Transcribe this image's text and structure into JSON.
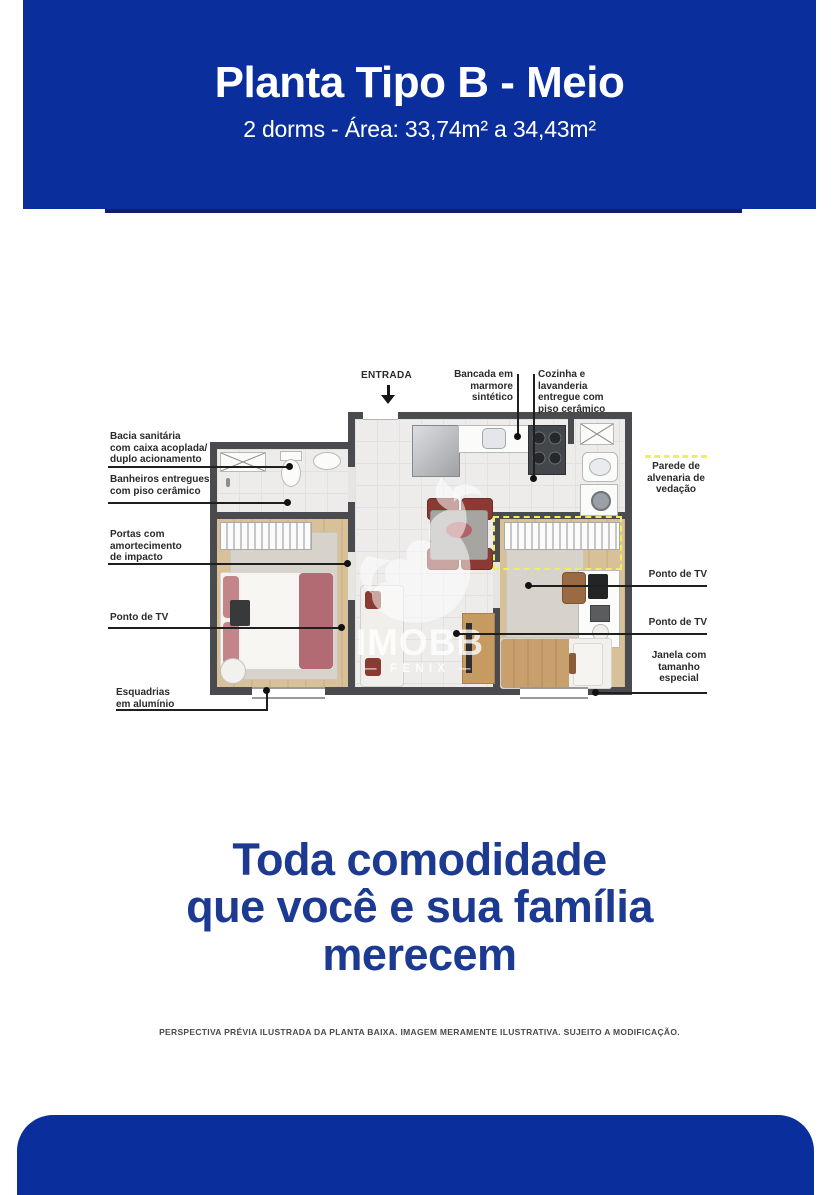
{
  "header": {
    "title": "Planta Tipo B - Meio",
    "subtitle": "2 dorms - Área: 33,74m² a 34,43m²"
  },
  "plan": {
    "entrance_label": "ENTRADA",
    "top_callouts": [
      {
        "label": "Bancada em\nmarmore\nsintético"
      },
      {
        "label": "Cozinha e\nlavanderia\nentregue com\npiso cerâmico"
      }
    ],
    "left_callouts": [
      {
        "label": "Bacia sanitária\ncom caixa acoplada/\nduplo acionamento"
      },
      {
        "label": "Banheiros entregues\ncom piso cerâmico"
      },
      {
        "label": "Portas com\namortecimento\nde impacto"
      },
      {
        "label": "Ponto de TV"
      },
      {
        "label": "Esquadrias\nem alumínio"
      }
    ],
    "right_callouts": [
      {
        "label": "Parede de\nalvenaria de\nvedação"
      },
      {
        "label": "Ponto de TV"
      },
      {
        "label": "Ponto de TV"
      },
      {
        "label": "Janela com\ntamanho\nespecial"
      }
    ],
    "watermark": {
      "brand": "IMOBB",
      "tagline": "— FENIX —"
    }
  },
  "headline": {
    "lines": [
      "Toda comodidade",
      "que você e sua família",
      "merecem"
    ]
  },
  "disclaimer": "PERSPECTIVA PRÉVIA ILUSTRADA DA PLANTA BAIXA. IMAGEM MERAMENTE ILUSTRATIVA. SUJEITO A MODIFICAÇÃO.",
  "colors": {
    "primary_blue": "#0b2e9d",
    "shadow_blue": "#101f66",
    "headline_blue": "#1d3a92",
    "highlight_yellow": "#ebf157"
  }
}
